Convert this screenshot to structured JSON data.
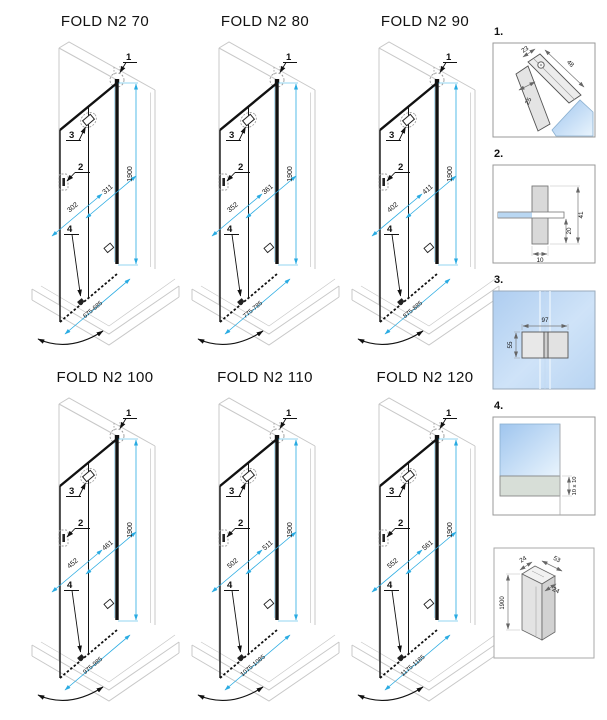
{
  "sheet_title": "FOLD N2 shower door size diagrams",
  "colors": {
    "dimension_accent": "#29abe2",
    "drawing_line": "#1a1a1a",
    "wall_outline": "#c8c8c8",
    "glass_blue": "#b9d7f2"
  },
  "diagrams": [
    {
      "title": "FOLD N2 70",
      "callout_1": "1",
      "callout_2": "2",
      "callout_3": "3",
      "callout_4": "4",
      "height": "1900",
      "fold_panel_width": "311",
      "fixed_panel_width": "302",
      "total_width": "675-685"
    },
    {
      "title": "FOLD N2 80",
      "callout_1": "1",
      "callout_2": "2",
      "callout_3": "3",
      "callout_4": "4",
      "height": "1900",
      "fold_panel_width": "361",
      "fixed_panel_width": "352",
      "total_width": "775-785"
    },
    {
      "title": "FOLD N2 90",
      "callout_1": "1",
      "callout_2": "2",
      "callout_3": "3",
      "callout_4": "4",
      "height": "1900",
      "fold_panel_width": "411",
      "fixed_panel_width": "402",
      "total_width": "875-885"
    },
    {
      "title": "FOLD N2 100",
      "callout_1": "1",
      "callout_2": "2",
      "callout_3": "3",
      "callout_4": "4",
      "height": "1900",
      "fold_panel_width": "461",
      "fixed_panel_width": "452",
      "total_width": "975-985"
    },
    {
      "title": "FOLD N2 110",
      "callout_1": "1",
      "callout_2": "2",
      "callout_3": "3",
      "callout_4": "4",
      "height": "1900",
      "fold_panel_width": "511",
      "fixed_panel_width": "502",
      "total_width": "1075-1085"
    },
    {
      "title": "FOLD N2 120",
      "callout_1": "1",
      "callout_2": "2",
      "callout_3": "3",
      "callout_4": "4",
      "height": "1900",
      "fold_panel_width": "561",
      "fixed_panel_width": "552",
      "total_width": "1175-1185"
    }
  ],
  "details": [
    {
      "label": "1.",
      "dim_a": "23",
      "dim_b": "48",
      "dim_c": "25"
    },
    {
      "label": "2.",
      "dim_height": "41",
      "dim_inner": "20",
      "dim_width": "10"
    },
    {
      "label": "3.",
      "dim_width": "97",
      "dim_height": "55"
    },
    {
      "label": "4.",
      "dim_seal": "10 x 10"
    },
    {
      "label": "",
      "dim_top": "24",
      "dim_side": "53",
      "dim_inner": "24",
      "dim_height": "1900"
    }
  ]
}
